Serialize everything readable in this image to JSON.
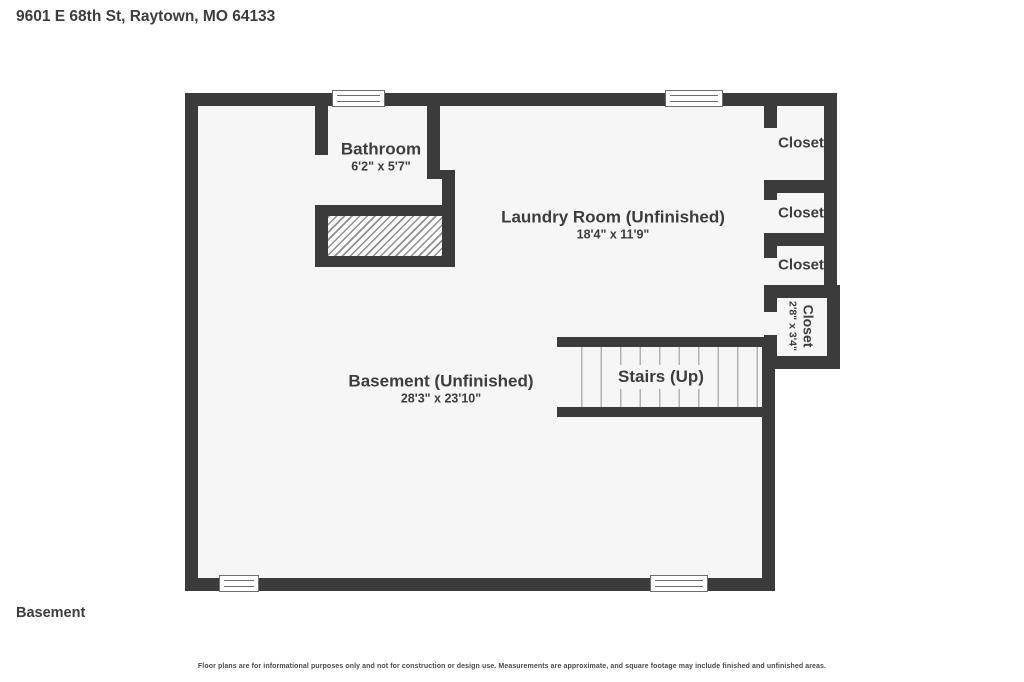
{
  "header": {
    "address": "9601 E 68th St, Raytown, MO 64133"
  },
  "floor_label": "Basement",
  "disclaimer": "Floor plans are for informational purposes only and not for construction or design use. Measurements are approximate, and square footage may include finished and unfinished areas.",
  "rooms": {
    "bathroom": {
      "name": "Bathroom",
      "dimensions": "6'2\" x 5'7\""
    },
    "laundry": {
      "name": "Laundry Room (Unfinished)",
      "dimensions": "18'4\" x 11'9\""
    },
    "basement": {
      "name": "Basement (Unfinished)",
      "dimensions": "28'3\" x 23'10\""
    },
    "stairs": {
      "name": "Stairs (Up)"
    },
    "closet1": {
      "name": "Closet"
    },
    "closet2": {
      "name": "Closet"
    },
    "closet3": {
      "name": "Closet"
    },
    "closet4": {
      "name": "Closet",
      "dimensions": "2'8\" x 3'4\""
    }
  },
  "colors": {
    "wall": "#3b3b3b",
    "floor": "#f6f6f6",
    "hatch_line": "#8f8f8f",
    "tread_line": "#b3b3b3",
    "window_border": "#6e6e6e",
    "text": "#3d3d3d"
  }
}
